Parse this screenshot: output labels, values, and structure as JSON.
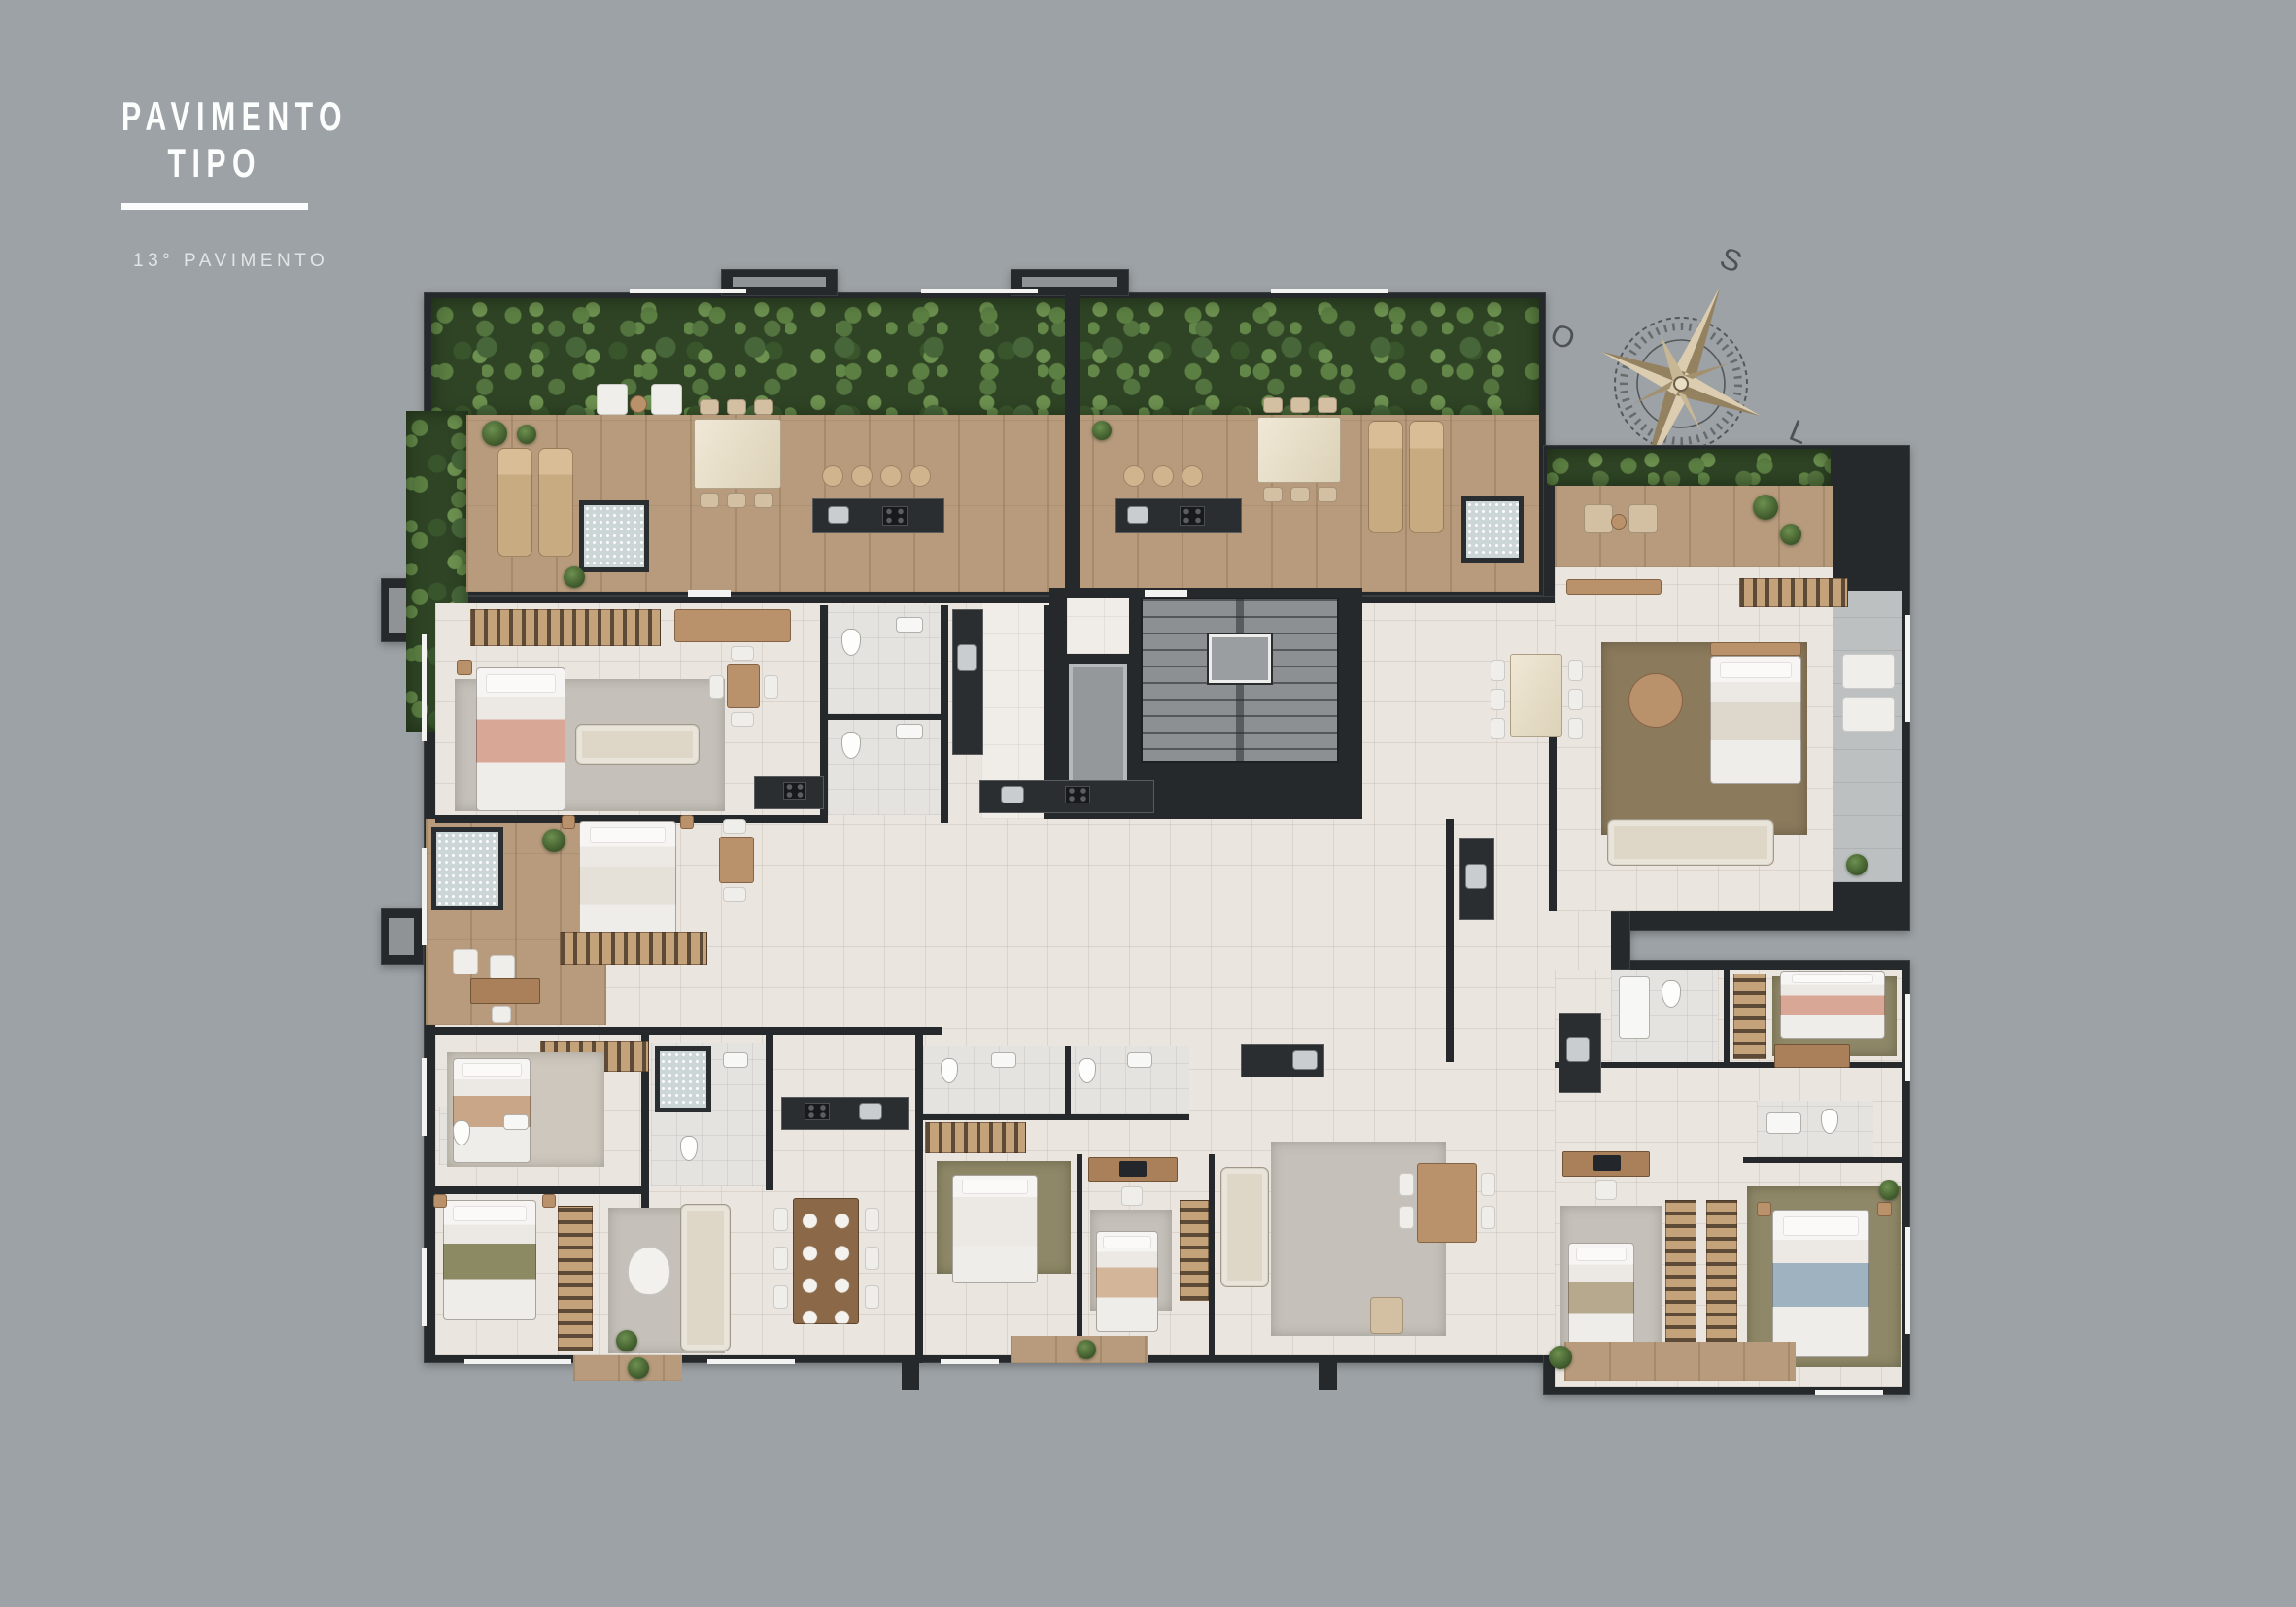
{
  "header": {
    "title_line1": "PAVIMENTO",
    "title_line2": "TIPO",
    "subtitle": "13° PAVIMENTO"
  },
  "compass": {
    "south": "S",
    "west": "O",
    "east": "L",
    "north": "N"
  },
  "plan": {
    "kind": "residential typical floor plan, top-down 3D render",
    "has_room_labels": false
  },
  "palette": {
    "background": "#9da2a6",
    "walls": "#26292b",
    "terrace_plants_green": "#3a5130",
    "deck_wood": "#b79b7c",
    "apartment_tile": "#eae5de",
    "balcony_tile": "#bdc0c1",
    "stair_core": "#8d9092",
    "rug": "#cdc7bd",
    "sofa_cream": "#ded6c6",
    "wood_furniture": "#b9916a",
    "marble": "#ece3cf",
    "kitchen_counter": "#2b2e30",
    "title_text": "#fcfdfd"
  }
}
